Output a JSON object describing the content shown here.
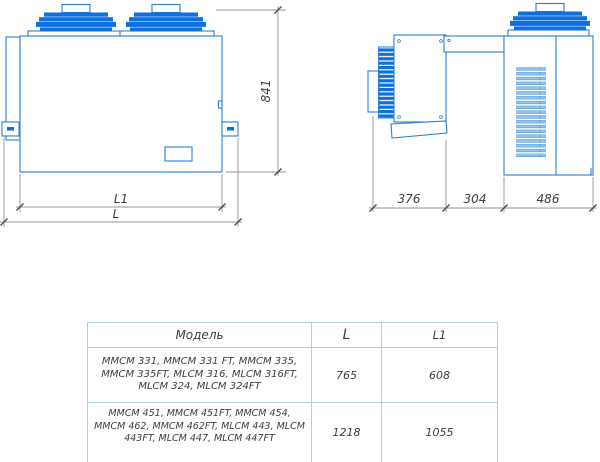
{
  "colors": {
    "line_blue": "#2a7fd4",
    "fill_blue": "#0d6fe0",
    "louver_blue": "#8fc1ea",
    "dim_gray": "#979797",
    "text_dark": "#3d3d3d",
    "table_border": "#a6d3e8"
  },
  "front_view": {
    "height_dim": "841",
    "inner_width_dim": "L1",
    "outer_width_dim": "L"
  },
  "side_view": {
    "evaporator_depth_dim": "376",
    "wall_gap_dim": "304",
    "condenser_depth_dim": "486"
  },
  "table": {
    "headers": {
      "model": "Модель",
      "l": "L",
      "l1": "L1"
    },
    "rows": [
      {
        "models": "MMCM 331, MMCM 331 FT, MMCM 335, MMCM 335FT, MLCM 316, MLCM 316FT, MLCM 324, MLCM 324FT",
        "l": "765",
        "l1": "608"
      },
      {
        "models": "MMCM 451, MMCM 451FT, MMCM 454, MMCM 462, MMCM 462FT, MLCM 443, MLCM 443FT, MLCM 447, MLCM 447FT",
        "l": "1218",
        "l1": "1055"
      }
    ]
  }
}
